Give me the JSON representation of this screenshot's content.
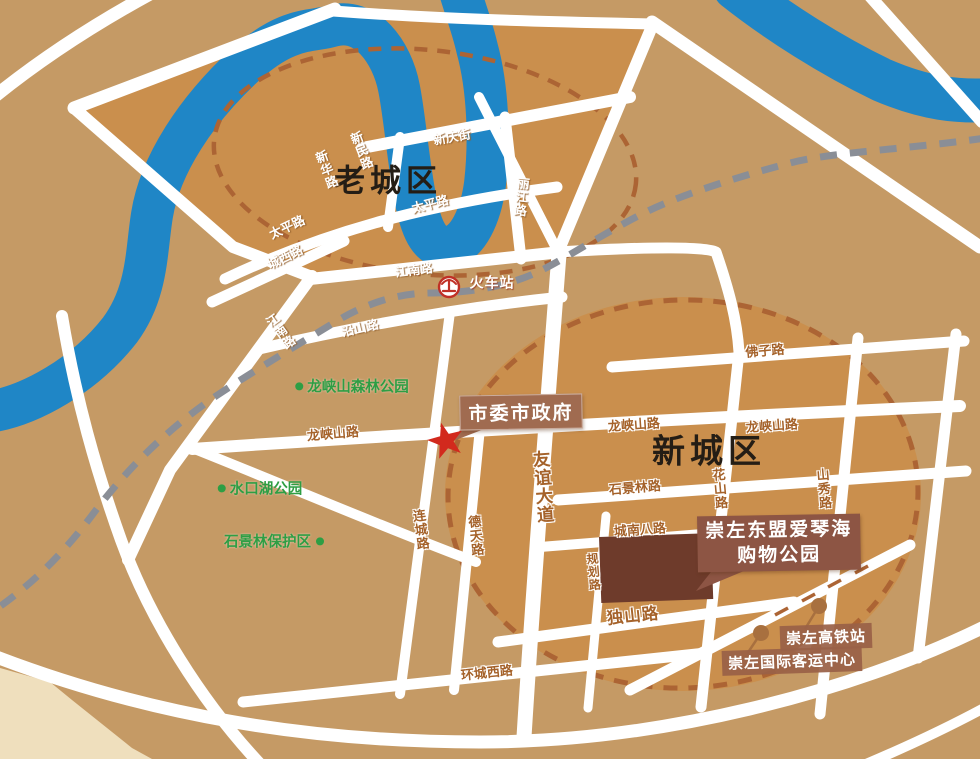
{
  "regions": {
    "old_town": "老城区",
    "new_town": "新城区"
  },
  "roads": [
    "新华路",
    "新民路",
    "新庆街",
    "太平路",
    "太平路",
    "丽江路",
    "城西路",
    "江南路",
    "江南路",
    "沿山路",
    "龙峡山路",
    "龙峡山路",
    "龙峡山路",
    "佛子路",
    "石景林路",
    "城南八路",
    "独山路",
    "环城西路",
    "友谊大道",
    "连城路",
    "德天路",
    "规划路",
    "花山路",
    "山秀路"
  ],
  "pois": {
    "train_station": "火车站",
    "government": "市委市政府",
    "shopping_line1": "崇左东盟爱琴海",
    "shopping_line2": "购物公园",
    "hsr_station": "崇左高铁站",
    "passenger_center": "崇左国际客运中心"
  },
  "parks": [
    "龙峡山森林公园",
    "水口湖公园",
    "石景林保护区"
  ],
  "colors": {
    "base": "#C59A65",
    "blocks": "#CA8F4D",
    "cream": "#EFDFBD",
    "river": "#1F86C6",
    "road": "#FFFFFF",
    "railway": "#8A8E96",
    "boundary": "#AC6434",
    "park_green": "#2E9E44",
    "road_label": "#A5622A",
    "region_label": "#241D15",
    "star": "#D2291D",
    "train_red": "#C03026",
    "building": "#6E3B2B",
    "gov_box": "#A06B50",
    "shop_box": "#8D5544",
    "station_box": "#9A6147",
    "dot": "#A8703F"
  }
}
